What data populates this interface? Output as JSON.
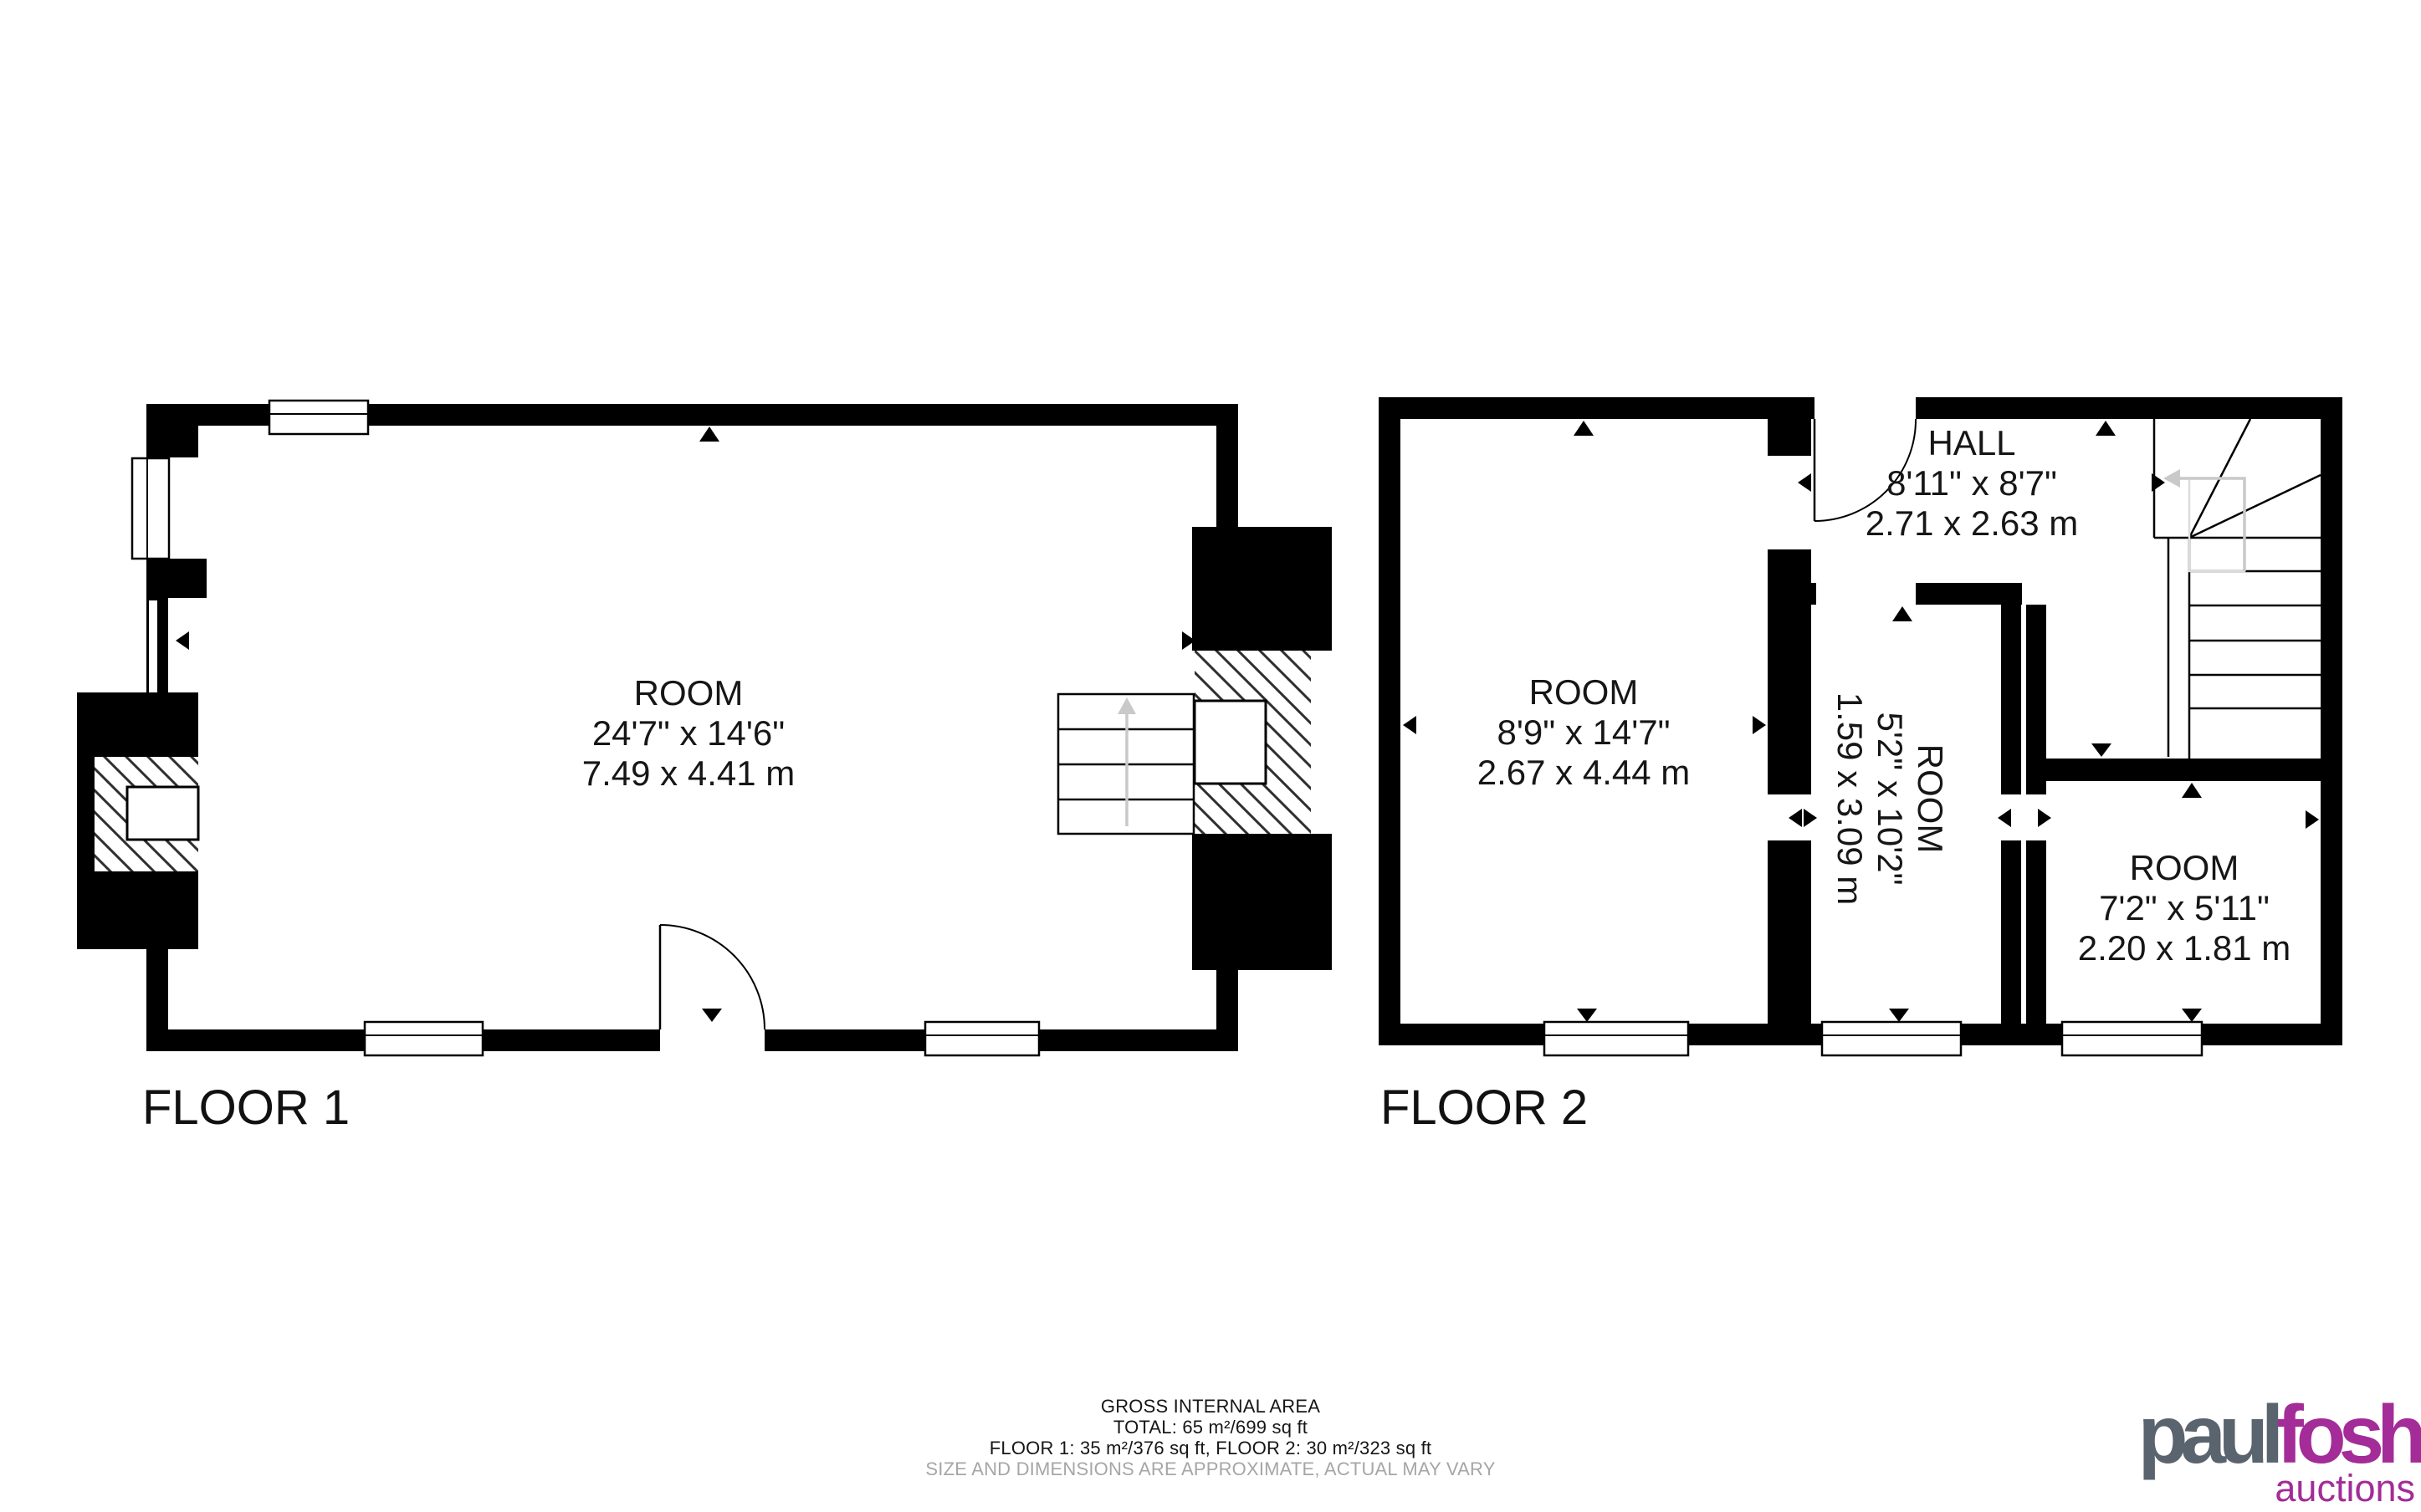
{
  "floor1": {
    "label": "FLOOR 1",
    "room": {
      "name": "ROOM",
      "dimensions_imperial": "24'7\" x 14'6\"",
      "dimensions_metric": "7.49 x 4.41 m"
    }
  },
  "floor2": {
    "label": "FLOOR 2",
    "hall": {
      "name": "HALL",
      "dimensions_imperial": "8'11\" x 8'7\"",
      "dimensions_metric": "2.71 x 2.63 m"
    },
    "room_left": {
      "name": "ROOM",
      "dimensions_imperial": "8'9\" x 14'7\"",
      "dimensions_metric": "2.67 x 4.44 m"
    },
    "room_middle": {
      "name": "ROOM",
      "dimensions_imperial": "5'2\" x 10'2\"",
      "dimensions_metric": "1.59 x 3.09 m"
    },
    "room_right": {
      "name": "ROOM",
      "dimensions_imperial": "7'2\" x 5'11\"",
      "dimensions_metric": "2.20 x 1.81 m"
    }
  },
  "footer": {
    "title": "GROSS INTERNAL AREA",
    "total": "TOTAL: 65 m²/699 sq ft",
    "floors": "FLOOR 1: 35 m²/376 sq ft, FLOOR 2: 30 m²/323 sq ft",
    "disclaimer": "SIZE AND DIMENSIONS ARE APPROXIMATE, ACTUAL MAY VARY"
  },
  "branding": {
    "name_part1": "paul",
    "name_part2": "fosh",
    "tagline": "auctions",
    "color_gray": "#5a646e",
    "color_magenta": "#a32c98"
  },
  "colors": {
    "wall": "#000000",
    "hatch_line": "#2f2f2f",
    "stair_arrow": "#c9c9c9",
    "disclaimer_gray": "#a6a6a6"
  }
}
